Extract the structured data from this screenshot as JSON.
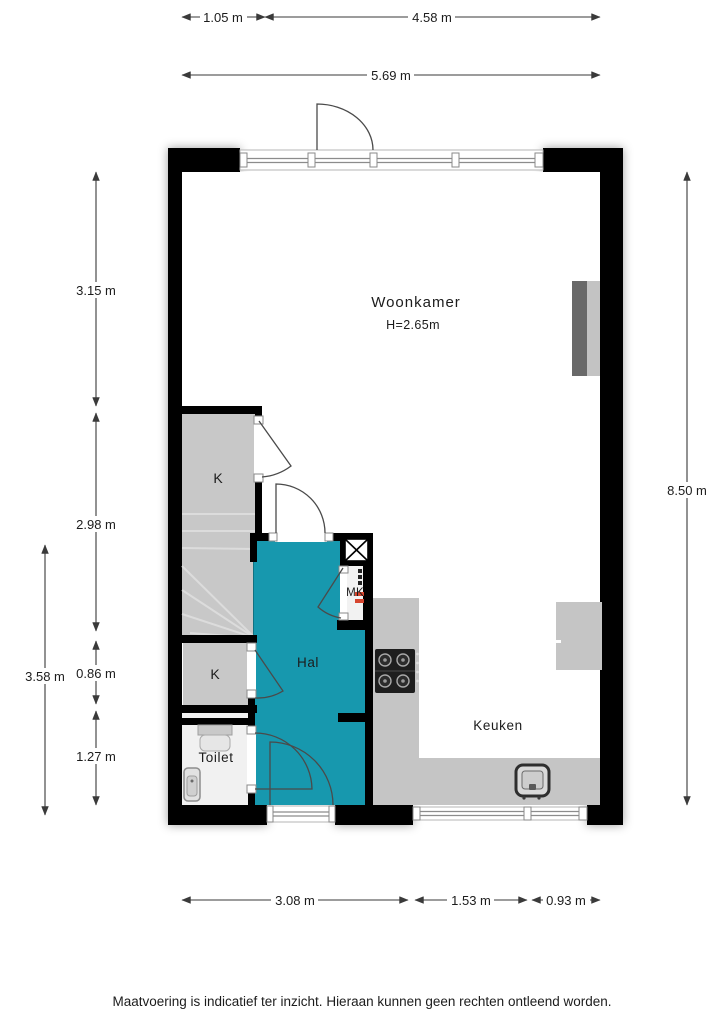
{
  "page": {
    "footer_disclaimer": "Maatvoering is indicatief ter inzicht. Hieraan kunnen geen rechten ontleend worden."
  },
  "colors": {
    "wall": "#000000",
    "hal_floor": "#1798ae",
    "closet_floor": "#c8c8c8",
    "toilet_floor": "#f1f1f1",
    "counter": "#c5c5c5",
    "glass_line": "#8c8c8c",
    "dim_line": "#3a3a3a",
    "door_line": "#4a4a4a",
    "label_text": "#1c1c1c",
    "appliance_dark": "#1e1e1e",
    "cabinet_dark": "#696969",
    "cabinet_light": "#c3c3c3",
    "accent_red": "#d6452e"
  },
  "rooms": {
    "woonkamer": {
      "label": "Woonkamer",
      "ceiling_height": "H=2.65m"
    },
    "keuken": {
      "label": "Keuken"
    },
    "hal": {
      "label": "Hal"
    },
    "toilet": {
      "label": "Toilet"
    },
    "closet_upper": {
      "label": "K"
    },
    "closet_lower": {
      "label": "K"
    },
    "meterkast": {
      "label": "MK"
    }
  },
  "dimensions": {
    "top": {
      "seg_left": "1.05 m",
      "seg_right": "4.58 m",
      "total": "5.69 m"
    },
    "bottom": {
      "seg_left": "3.08 m",
      "seg_mid": "1.53 m",
      "seg_right": "0.93 m"
    },
    "left_inner": {
      "seg1": "3.15 m",
      "seg2": "2.98 m",
      "seg3": "0.86 m",
      "seg4": "1.27 m"
    },
    "left_outer": {
      "total": "3.58 m"
    },
    "right": {
      "total": "8.50 m"
    }
  }
}
